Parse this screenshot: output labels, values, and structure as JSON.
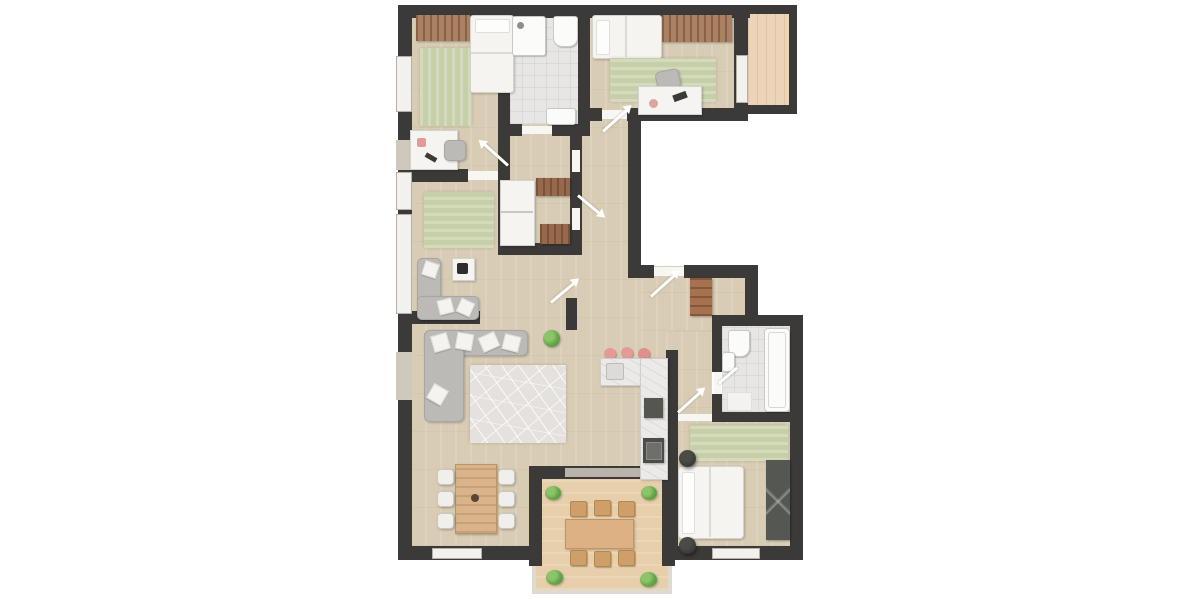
{
  "scene": {
    "type": "apartment-floor-plan-render",
    "background": "#ffffff",
    "text_labels": [],
    "colors": {
      "wall": "#3c3a38",
      "wood_floor": "#d8ccb4",
      "bathroom_tile": "#e7e6e4",
      "terrace_deck": "#e6cfaa",
      "balcony_deck": "#ecd4b8",
      "rug_green": "#c6cfa7",
      "rug_living": "#e4e1de",
      "sofa_gray": "#bbbab6",
      "bed_white": "#f5f4f1",
      "wardrobe_brown": "#ab8164",
      "wardrobe_dark": "#545752",
      "kitchen_counter": "#eceae8",
      "appliance_dark": "#4b4b49",
      "stool_pink": "#e59a96",
      "plant_green": "#69a74d",
      "window_sill": "#cfc8bd",
      "door_arrow": "#ffffff",
      "outdoor_table": "#ddb184"
    },
    "rooms": [
      {
        "id": "bedroom-top-left",
        "furniture": [
          "wardrobe",
          "single-bed",
          "green-striped-rug",
          "desk",
          "desk-chair"
        ]
      },
      {
        "id": "bathroom-top",
        "furniture": [
          "shower",
          "toilet",
          "sink"
        ]
      },
      {
        "id": "bedroom-top-right",
        "furniture": [
          "single-bed",
          "wardrobe",
          "green-striped-rug",
          "desk",
          "desk-chair"
        ]
      },
      {
        "id": "balcony-top-right",
        "furniture": []
      },
      {
        "id": "lounge-middle-left",
        "furniture": [
          "green-striped-rug",
          "corner-sofa",
          "coffee-table"
        ]
      },
      {
        "id": "utility-closet",
        "furniture": [
          "washer-dryer-stack",
          "shelf-unit-top",
          "shelf-unit-bottom"
        ]
      },
      {
        "id": "living-room",
        "furniture": [
          "corner-sofa",
          "patterned-rug",
          "potted-plant",
          "dining-table",
          "six-chairs"
        ]
      },
      {
        "id": "kitchen",
        "furniture": [
          "l-shaped-counter",
          "sink",
          "cooktop",
          "oven-column",
          "three-pink-stools"
        ]
      },
      {
        "id": "entry-hall",
        "furniture": [
          "entry-cabinet"
        ]
      },
      {
        "id": "bathroom-small",
        "furniture": [
          "toilet",
          "sink",
          "bathtub",
          "bath-mat"
        ]
      },
      {
        "id": "bedroom-bottom-right",
        "furniture": [
          "double-bed",
          "two-dark-planters",
          "green-striped-rug",
          "dark-wardrobe"
        ]
      },
      {
        "id": "terrace-bottom",
        "furniture": [
          "outdoor-table",
          "six-outdoor-chairs",
          "four-potted-plants"
        ]
      }
    ],
    "door_arrows_count": 6,
    "windows": [
      "left-wall-3",
      "bottom-left-wall-1",
      "bedroom-bottom-right-wall-1",
      "balcony-opening-1",
      "terrace-opening-1"
    ]
  }
}
